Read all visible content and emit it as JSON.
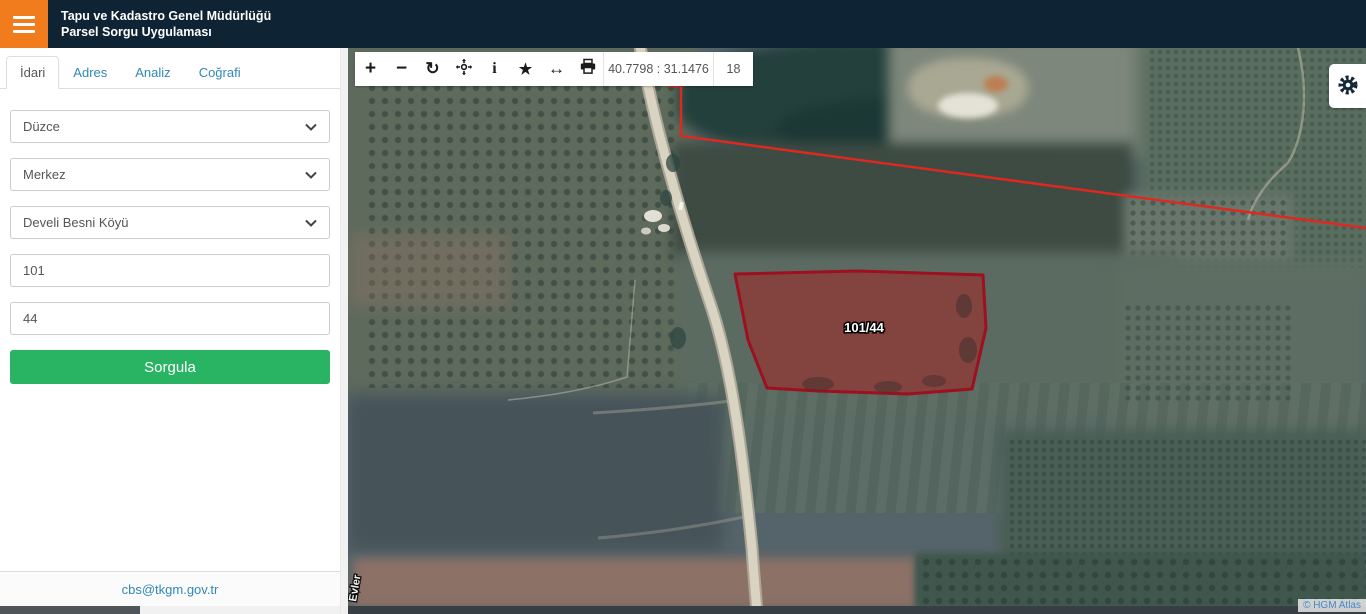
{
  "header": {
    "title_line1": "Tapu ve Kadastro Genel Müdürlüğü",
    "title_line2": "Parsel Sorgu Uygulaması"
  },
  "sidebar": {
    "tabs": [
      {
        "label": "İdari",
        "active": true
      },
      {
        "label": "Adres",
        "active": false
      },
      {
        "label": "Analiz",
        "active": false
      },
      {
        "label": "Coğrafi",
        "active": false
      }
    ],
    "form": {
      "province_select": "Düzce",
      "district_select": "Merkez",
      "neighborhood_select": "Develi Besni Köyü",
      "block_input": "101",
      "parcel_input": "44",
      "query_button_label": "Sorgula"
    },
    "footer_link": "cbs@tkgm.gov.tr"
  },
  "map": {
    "toolbar": {
      "coordinates": "40.7798 : 31.1476",
      "zoom_level": "18",
      "icons": [
        {
          "name": "zoom-in-icon",
          "glyph": "+"
        },
        {
          "name": "zoom-out-icon",
          "glyph": "−"
        },
        {
          "name": "refresh-icon",
          "glyph": "↻"
        },
        {
          "name": "pan-icon",
          "glyph": null
        },
        {
          "name": "info-icon",
          "glyph": "i"
        },
        {
          "name": "favorite-icon",
          "glyph": "★"
        },
        {
          "name": "measure-icon",
          "glyph": "↔"
        },
        {
          "name": "print-icon",
          "glyph": null
        }
      ]
    },
    "parcel": {
      "label": "101/44"
    },
    "street_label": "Evler",
    "attribution": "© HGM Atlas",
    "colors": {
      "header_bg": "#0e2334",
      "accent_orange": "#f07c1e",
      "button_green": "#28b462",
      "link_blue": "#3187b5",
      "parcel_stroke": "#9d1020",
      "parcel_fill": "rgba(179,32,44,0.35)",
      "boundary_red": "#e2281e"
    }
  }
}
